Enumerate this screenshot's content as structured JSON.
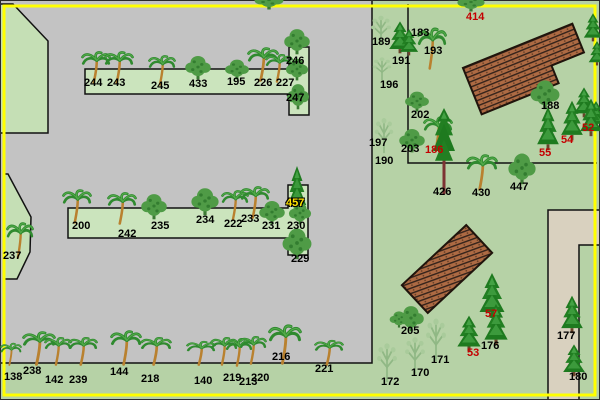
{
  "app": {
    "description": "overhead park map with numbered trees",
    "palette": {
      "grass_green": "#b6d2a6",
      "planter_green": "#cbe4bd",
      "polygon_green": "#c5dfb5",
      "pavement_gray": "#c3c3c3",
      "sand_tan": "#d9d1bf",
      "roof_brown": "#ad6a43",
      "roof_hatch_dark": "#33221a",
      "border_yellow": "#ffff00",
      "label_black": "#000000",
      "label_red": "#c40000",
      "label_yellow": "#ffe400"
    }
  },
  "map": {
    "buildings": [
      {
        "name": "hatched-roof-building-1"
      },
      {
        "name": "hatched-roof-building-2"
      },
      {
        "name": "sand-courtyard-building"
      }
    ],
    "labels": [
      {
        "text": "244",
        "x": 84,
        "y": 77,
        "color": "black"
      },
      {
        "text": "243",
        "x": 107,
        "y": 77,
        "color": "black"
      },
      {
        "text": "245",
        "x": 151,
        "y": 80,
        "color": "black"
      },
      {
        "text": "433",
        "x": 189,
        "y": 78,
        "color": "black"
      },
      {
        "text": "195",
        "x": 227,
        "y": 76,
        "color": "black"
      },
      {
        "text": "226",
        "x": 254,
        "y": 77,
        "color": "black"
      },
      {
        "text": "227",
        "x": 276,
        "y": 77,
        "color": "black"
      },
      {
        "text": "246",
        "x": 286,
        "y": 55,
        "color": "black"
      },
      {
        "text": "247",
        "x": 286,
        "y": 92,
        "color": "black"
      },
      {
        "text": "200",
        "x": 72,
        "y": 220,
        "color": "black"
      },
      {
        "text": "242",
        "x": 118,
        "y": 228,
        "color": "black"
      },
      {
        "text": "235",
        "x": 151,
        "y": 220,
        "color": "black"
      },
      {
        "text": "234",
        "x": 196,
        "y": 214,
        "color": "black"
      },
      {
        "text": "222",
        "x": 224,
        "y": 218,
        "color": "black"
      },
      {
        "text": "233",
        "x": 241,
        "y": 213,
        "color": "black"
      },
      {
        "text": "231",
        "x": 262,
        "y": 220,
        "color": "black"
      },
      {
        "text": "230",
        "x": 287,
        "y": 220,
        "color": "black"
      },
      {
        "text": "457",
        "x": 286,
        "y": 197,
        "color": "yellow"
      },
      {
        "text": "229",
        "x": 291,
        "y": 253,
        "color": "black"
      },
      {
        "text": "237",
        "x": 3,
        "y": 250,
        "color": "black"
      },
      {
        "text": "138",
        "x": 4,
        "y": 371,
        "color": "black"
      },
      {
        "text": "238",
        "x": 23,
        "y": 365,
        "color": "black"
      },
      {
        "text": "142",
        "x": 45,
        "y": 374,
        "color": "black"
      },
      {
        "text": "239",
        "x": 69,
        "y": 374,
        "color": "black"
      },
      {
        "text": "144",
        "x": 110,
        "y": 366,
        "color": "black"
      },
      {
        "text": "218",
        "x": 141,
        "y": 373,
        "color": "black"
      },
      {
        "text": "140",
        "x": 194,
        "y": 375,
        "color": "black"
      },
      {
        "text": "219",
        "x": 223,
        "y": 372,
        "color": "black"
      },
      {
        "text": "213",
        "x": 239,
        "y": 376,
        "color": "black"
      },
      {
        "text": "220",
        "x": 251,
        "y": 372,
        "color": "black"
      },
      {
        "text": "216",
        "x": 272,
        "y": 351,
        "color": "black"
      },
      {
        "text": "221",
        "x": 315,
        "y": 363,
        "color": "black"
      },
      {
        "text": "189",
        "x": 372,
        "y": 36,
        "color": "black"
      },
      {
        "text": "183",
        "x": 411,
        "y": 27,
        "color": "black"
      },
      {
        "text": "193",
        "x": 424,
        "y": 45,
        "color": "black"
      },
      {
        "text": "191",
        "x": 392,
        "y": 55,
        "color": "black"
      },
      {
        "text": "196",
        "x": 380,
        "y": 79,
        "color": "black"
      },
      {
        "text": "202",
        "x": 411,
        "y": 109,
        "color": "black"
      },
      {
        "text": "197",
        "x": 369,
        "y": 137,
        "color": "black"
      },
      {
        "text": "203",
        "x": 401,
        "y": 143,
        "color": "black"
      },
      {
        "text": "186",
        "x": 425,
        "y": 144,
        "color": "red"
      },
      {
        "text": "190",
        "x": 375,
        "y": 155,
        "color": "black"
      },
      {
        "text": "414",
        "x": 466,
        "y": 11,
        "color": "red"
      },
      {
        "text": "426",
        "x": 433,
        "y": 186,
        "color": "black"
      },
      {
        "text": "430",
        "x": 472,
        "y": 187,
        "color": "black"
      },
      {
        "text": "447",
        "x": 510,
        "y": 181,
        "color": "black"
      },
      {
        "text": "188",
        "x": 541,
        "y": 100,
        "color": "black"
      },
      {
        "text": "52",
        "x": 582,
        "y": 122,
        "color": "red"
      },
      {
        "text": "54",
        "x": 561,
        "y": 134,
        "color": "red"
      },
      {
        "text": "55",
        "x": 539,
        "y": 147,
        "color": "red"
      },
      {
        "text": "205",
        "x": 401,
        "y": 325,
        "color": "black"
      },
      {
        "text": "57",
        "x": 485,
        "y": 308,
        "color": "red"
      },
      {
        "text": "176",
        "x": 481,
        "y": 340,
        "color": "black"
      },
      {
        "text": "53",
        "x": 467,
        "y": 347,
        "color": "red"
      },
      {
        "text": "171",
        "x": 431,
        "y": 354,
        "color": "black"
      },
      {
        "text": "170",
        "x": 411,
        "y": 367,
        "color": "black"
      },
      {
        "text": "172",
        "x": 381,
        "y": 376,
        "color": "black"
      },
      {
        "text": "177",
        "x": 557,
        "y": 330,
        "color": "black"
      },
      {
        "text": "180",
        "x": 569,
        "y": 371,
        "color": "black"
      }
    ],
    "trees": [
      {
        "type": "palm",
        "x": 81,
        "y": 50,
        "w": 30,
        "h": 34
      },
      {
        "type": "palm",
        "x": 104,
        "y": 50,
        "w": 30,
        "h": 34
      },
      {
        "type": "palm",
        "x": 148,
        "y": 54,
        "w": 28,
        "h": 32
      },
      {
        "type": "deciduous",
        "x": 183,
        "y": 54,
        "w": 30,
        "h": 26
      },
      {
        "type": "deciduous",
        "x": 223,
        "y": 58,
        "w": 28,
        "h": 22
      },
      {
        "type": "palm",
        "x": 247,
        "y": 46,
        "w": 32,
        "h": 36
      },
      {
        "type": "palm",
        "x": 265,
        "y": 53,
        "w": 28,
        "h": 30
      },
      {
        "type": "deciduous",
        "x": 282,
        "y": 27,
        "w": 30,
        "h": 28
      },
      {
        "type": "deciduous",
        "x": 284,
        "y": 57,
        "w": 26,
        "h": 24
      },
      {
        "type": "deciduous",
        "x": 285,
        "y": 82,
        "w": 26,
        "h": 28
      },
      {
        "type": "palm",
        "x": 62,
        "y": 188,
        "w": 30,
        "h": 36
      },
      {
        "type": "palm",
        "x": 107,
        "y": 191,
        "w": 30,
        "h": 34
      },
      {
        "type": "deciduous",
        "x": 139,
        "y": 192,
        "w": 30,
        "h": 28
      },
      {
        "type": "deciduous",
        "x": 189,
        "y": 186,
        "w": 32,
        "h": 30
      },
      {
        "type": "palm",
        "x": 221,
        "y": 189,
        "w": 28,
        "h": 32
      },
      {
        "type": "palm",
        "x": 240,
        "y": 185,
        "w": 30,
        "h": 34
      },
      {
        "type": "deciduous",
        "x": 257,
        "y": 199,
        "w": 30,
        "h": 26
      },
      {
        "type": "conifer",
        "x": 286,
        "y": 164,
        "w": 22,
        "h": 48
      },
      {
        "type": "deciduous",
        "x": 287,
        "y": 201,
        "w": 26,
        "h": 24
      },
      {
        "type": "deciduous",
        "x": 280,
        "y": 226,
        "w": 34,
        "h": 34
      },
      {
        "type": "palm",
        "x": 6,
        "y": 221,
        "w": 28,
        "h": 38
      },
      {
        "type": "palm",
        "x": 0,
        "y": 342,
        "w": 22,
        "h": 24
      },
      {
        "type": "palm",
        "x": 22,
        "y": 330,
        "w": 34,
        "h": 36
      },
      {
        "type": "palm",
        "x": 44,
        "y": 336,
        "w": 28,
        "h": 30
      },
      {
        "type": "palm",
        "x": 68,
        "y": 336,
        "w": 30,
        "h": 30
      },
      {
        "type": "palm",
        "x": 110,
        "y": 329,
        "w": 32,
        "h": 37
      },
      {
        "type": "palm",
        "x": 140,
        "y": 336,
        "w": 32,
        "h": 30
      },
      {
        "type": "palm",
        "x": 186,
        "y": 340,
        "w": 30,
        "h": 26
      },
      {
        "type": "palm",
        "x": 210,
        "y": 336,
        "w": 28,
        "h": 30
      },
      {
        "type": "palm",
        "x": 225,
        "y": 337,
        "w": 28,
        "h": 30
      },
      {
        "type": "palm",
        "x": 239,
        "y": 335,
        "w": 28,
        "h": 30
      },
      {
        "type": "palm",
        "x": 268,
        "y": 323,
        "w": 34,
        "h": 42
      },
      {
        "type": "palm",
        "x": 314,
        "y": 339,
        "w": 30,
        "h": 27
      },
      {
        "type": "deciduous",
        "x": 252,
        "y": -10,
        "w": 34,
        "h": 20
      },
      {
        "type": "deciduous",
        "x": 455,
        "y": -8,
        "w": 32,
        "h": 20
      },
      {
        "type": "sparse",
        "x": 367,
        "y": 14,
        "w": 28,
        "h": 32
      },
      {
        "type": "conifer",
        "x": 387,
        "y": 20,
        "w": 26,
        "h": 34
      },
      {
        "type": "conifer",
        "x": 398,
        "y": 28,
        "w": 22,
        "h": 28
      },
      {
        "type": "palm",
        "x": 417,
        "y": 26,
        "w": 30,
        "h": 44
      },
      {
        "type": "sparse",
        "x": 369,
        "y": 56,
        "w": 26,
        "h": 26
      },
      {
        "type": "deciduous",
        "x": 403,
        "y": 90,
        "w": 28,
        "h": 22
      },
      {
        "type": "sparse",
        "x": 371,
        "y": 116,
        "w": 26,
        "h": 38
      },
      {
        "type": "deciduous",
        "x": 397,
        "y": 127,
        "w": 30,
        "h": 26
      },
      {
        "type": "palm",
        "x": 423,
        "y": 115,
        "w": 30,
        "h": 36
      },
      {
        "type": "tall-pine",
        "x": 431,
        "y": 106,
        "w": 26,
        "h": 90
      },
      {
        "type": "palm",
        "x": 466,
        "y": 153,
        "w": 32,
        "h": 38
      },
      {
        "type": "deciduous",
        "x": 506,
        "y": 151,
        "w": 32,
        "h": 34
      },
      {
        "type": "deciduous",
        "x": 528,
        "y": 78,
        "w": 34,
        "h": 32
      },
      {
        "type": "conifer",
        "x": 572,
        "y": 86,
        "w": 24,
        "h": 32
      },
      {
        "type": "conifer",
        "x": 585,
        "y": 100,
        "w": 22,
        "h": 28
      },
      {
        "type": "conifer",
        "x": 535,
        "y": 105,
        "w": 26,
        "h": 46
      },
      {
        "type": "conifer",
        "x": 559,
        "y": 99,
        "w": 26,
        "h": 42
      },
      {
        "type": "conifer",
        "x": 578,
        "y": 97,
        "w": 26,
        "h": 40
      },
      {
        "type": "conifer",
        "x": 582,
        "y": 12,
        "w": 22,
        "h": 30
      },
      {
        "type": "conifer",
        "x": 587,
        "y": 40,
        "w": 20,
        "h": 26
      },
      {
        "type": "deciduous",
        "x": 396,
        "y": 304,
        "w": 30,
        "h": 28
      },
      {
        "type": "deciduous",
        "x": 388,
        "y": 310,
        "w": 22,
        "h": 18
      },
      {
        "type": "conifer",
        "x": 477,
        "y": 271,
        "w": 30,
        "h": 48
      },
      {
        "type": "conifer",
        "x": 455,
        "y": 314,
        "w": 28,
        "h": 38
      },
      {
        "type": "conifer",
        "x": 482,
        "y": 302,
        "w": 28,
        "h": 44
      },
      {
        "type": "sparse",
        "x": 373,
        "y": 341,
        "w": 28,
        "h": 42
      },
      {
        "type": "sparse",
        "x": 401,
        "y": 335,
        "w": 28,
        "h": 40
      },
      {
        "type": "sparse",
        "x": 422,
        "y": 316,
        "w": 28,
        "h": 46
      },
      {
        "type": "conifer",
        "x": 559,
        "y": 294,
        "w": 26,
        "h": 40
      },
      {
        "type": "conifer",
        "x": 561,
        "y": 343,
        "w": 26,
        "h": 34
      }
    ]
  }
}
